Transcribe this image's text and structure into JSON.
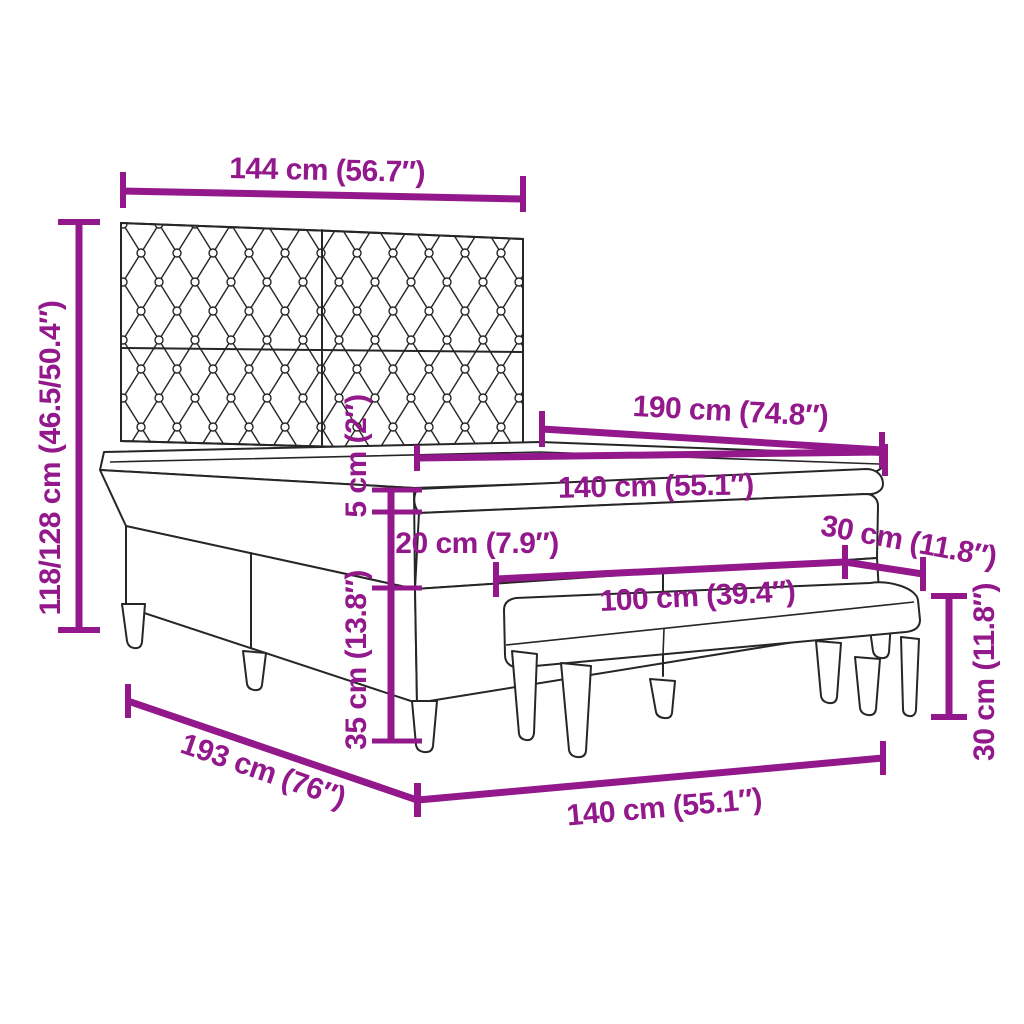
{
  "diagram": {
    "type": "product-dimension-diagram",
    "subject": "box spring bed with tufted headboard, mattress, topper and bench",
    "background_color": "#FFFFFF",
    "outline_color": "#262626",
    "annotation_color": "#92188B"
  },
  "measurements": [
    {
      "id": "headboard-width",
      "label": "144 cm (56.7″)",
      "cm": "144",
      "inches": "56.7"
    },
    {
      "id": "total-height",
      "label": "118/128 cm (46.5/50.4″)",
      "cm": "118/128",
      "inches": "46.5/50.4"
    },
    {
      "id": "bed-length",
      "label": "190 cm (74.8″)",
      "cm": "190",
      "inches": "74.8"
    },
    {
      "id": "mattress-width",
      "label": "140 cm (55.1″)",
      "cm": "140",
      "inches": "55.1"
    },
    {
      "id": "topper-height",
      "label": "5 cm (2″)",
      "cm": "5",
      "inches": "2"
    },
    {
      "id": "mattress-height",
      "label": "20 cm (7.9″)",
      "cm": "20",
      "inches": "7.9"
    },
    {
      "id": "bench-depth",
      "label": "30 cm (11.8″)",
      "cm": "30",
      "inches": "11.8"
    },
    {
      "id": "bench-length",
      "label": "100 cm (39.4″)",
      "cm": "100",
      "inches": "39.4"
    },
    {
      "id": "base-height",
      "label": "35 cm (13.8″)",
      "cm": "35",
      "inches": "13.8"
    },
    {
      "id": "bench-height",
      "label": "30 cm (11.8″)",
      "cm": "30",
      "inches": "11.8"
    },
    {
      "id": "frame-length",
      "label": "193 cm (76″)",
      "cm": "193",
      "inches": "76"
    },
    {
      "id": "bed-width",
      "label": "140 cm (55.1″)",
      "cm": "140",
      "inches": "55.1"
    }
  ]
}
